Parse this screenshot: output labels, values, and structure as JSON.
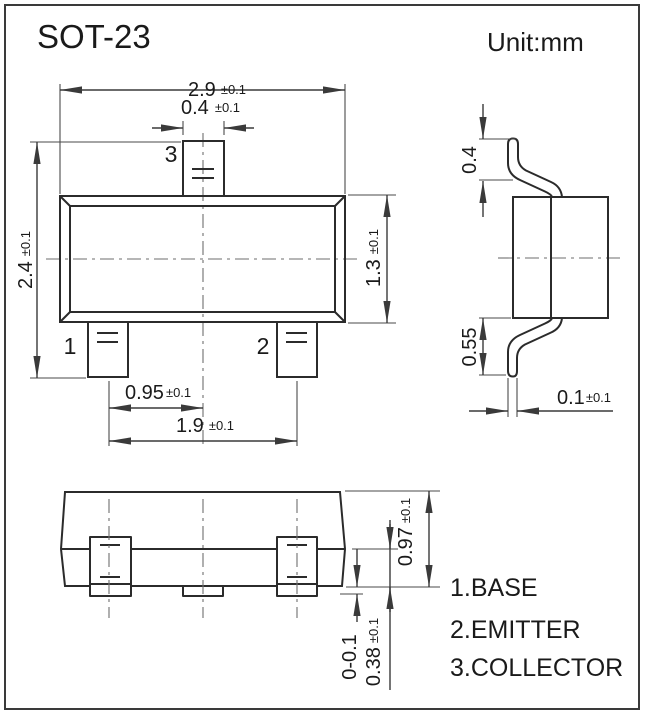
{
  "title": "SOT-23",
  "unit": "Unit:mm",
  "pins": {
    "p1": "1",
    "p2": "2",
    "p3": "3"
  },
  "legend": {
    "line1": "1.BASE",
    "line2": "2.EMITTER",
    "line3": "3.COLLECTOR"
  },
  "dims": {
    "body_width": {
      "value": "2.9",
      "tol": "±0.1"
    },
    "pin3_width": {
      "value": "0.4",
      "tol": "±0.1"
    },
    "overall_depth": {
      "value": "2.4",
      "tol": "±0.1"
    },
    "body_depth": {
      "value": "1.3",
      "tol": "±0.1"
    },
    "pin_pitch": {
      "value": "0.95",
      "tol": "±0.1"
    },
    "pin_span": {
      "value": "1.9",
      "tol": "±0.1"
    },
    "lead_rise": {
      "value": "0.4",
      "tol": ""
    },
    "lead_drop": {
      "value": "0.55",
      "tol": ""
    },
    "lead_thickness": {
      "value": "0.1",
      "tol": "±0.1"
    },
    "body_height": {
      "value": "0.97",
      "tol": "±0.1"
    },
    "standoff": {
      "value": "0-0.1",
      "tol": ""
    },
    "lead_foot": {
      "value": "0.38",
      "tol": "±0.1"
    }
  },
  "colors": {
    "background": "#ffffff",
    "line": "#2b2b2b",
    "dimension": "#3a3a3a",
    "centerline": "#6e6e6e",
    "text": "#1a1a1a"
  }
}
